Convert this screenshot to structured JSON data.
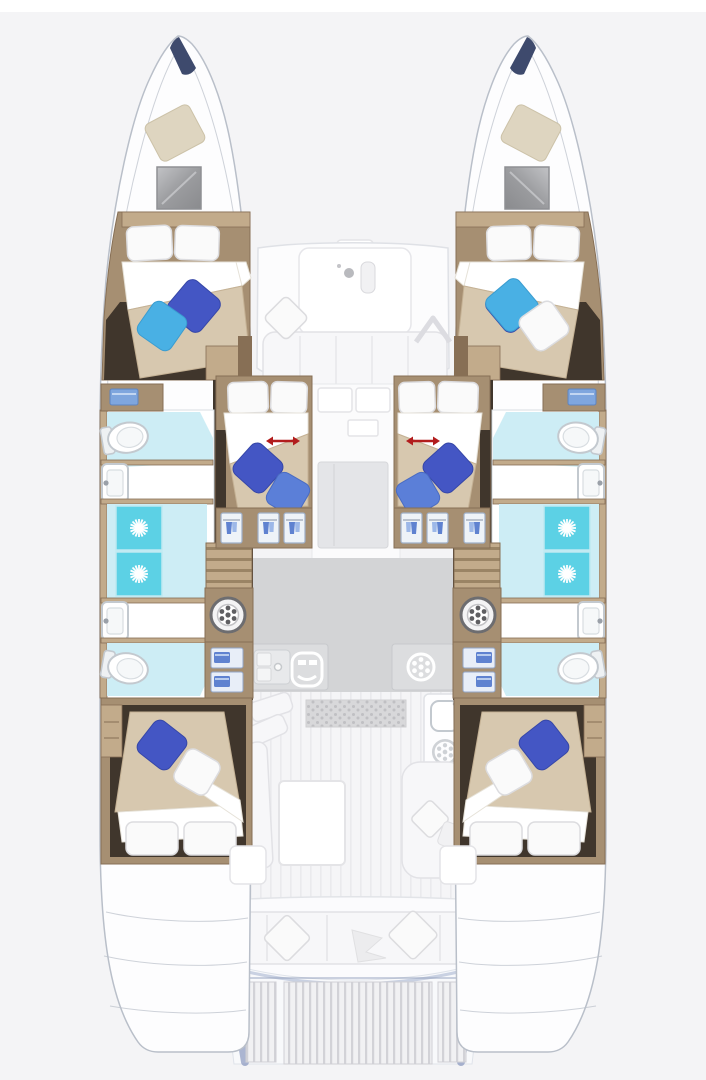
{
  "diagram": {
    "title": "Catamaran accommodation floor plan, top view",
    "vessel_type": "sailing catamaran",
    "view": "overhead deck and interior layout",
    "regions": {
      "port_bow_cabin": "forward double cabin (port hull)",
      "starboard_bow_cabin": "forward double cabin (starboard hull)",
      "port_mid_cabin": "midship double cabin with sliding berth (port)",
      "starboard_mid_cabin": "midship double cabin with sliding berth (starboard)",
      "port_aft_cabin": "aft double cabin (port hull)",
      "starboard_aft_cabin": "aft double cabin (starboard hull)",
      "port_bathroom": "port hull bathroom block",
      "starboard_bathroom": "starboard hull bathroom block",
      "foredeck_lounge": "foredeck seating with table",
      "salon_galley": "salon with galley counters and table",
      "cockpit": "aft cockpit bench seating",
      "swim_platform": "aft swim platform with teak slats"
    },
    "features": {
      "double_cabins": 6,
      "bathrooms": 4,
      "shower_stalls": 4,
      "toilets": 4,
      "washbasins": 4,
      "washing_machines": 2,
      "sliding_partition_arrows": 4
    },
    "icons": [
      "toilet-icon",
      "washbasin-icon",
      "shower-drain-icon",
      "washing-machine-icon",
      "stove-burner-icon",
      "oven-icon",
      "galley-sink-icon",
      "hanging-locker-icon",
      "slide-arrow-icon",
      "bow-hatch-icon",
      "sail-locker-icon"
    ]
  },
  "colors": {
    "bg": "#f4f4f6",
    "hull": "#fdfdfe",
    "hull-line": "#b9bfc9",
    "navy": "#3e4a6d",
    "sailbag": "#ded5c0",
    "wood": "#a68f72",
    "wood-light": "#c2ab8b",
    "wood-dark": "#876f55",
    "floor-dark": "#40362c",
    "bed": "#d7c8af",
    "pillow": "#fafafa",
    "pillow-royal": "#4456c4",
    "pillow-blue": "#5b7fd8",
    "pillow-sky": "#49b0e4",
    "shower": "#5cd1e5",
    "bath-pale": "#cdedf5",
    "fixture-line": "#c3c9cf",
    "galley-floor": "#d3d4d6",
    "counter": "#dcdddf",
    "arrow-red": "#b21d1d",
    "platform-blue": "#6b7eae"
  }
}
